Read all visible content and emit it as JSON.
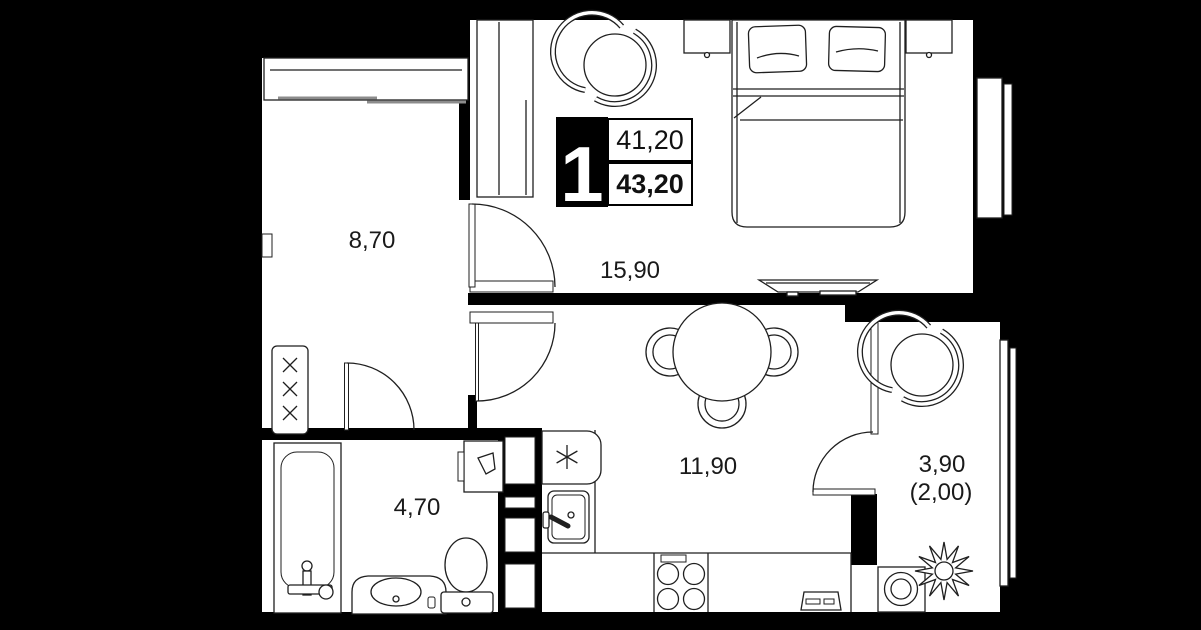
{
  "badge": {
    "room_count": "1",
    "area_living": "41,20",
    "area_total": "43,20"
  },
  "labels": {
    "hallway": "8,70",
    "living_room": "15,90",
    "kitchen": "11,90",
    "bathroom": "4,70",
    "balcony": "3,90",
    "balcony_coef": "(2,00)"
  },
  "colors": {
    "background": "#000000",
    "wall": "#000000",
    "floor": "#ffffff",
    "line": "#1f1f1f",
    "accent_gray": "#8c8c8c"
  }
}
